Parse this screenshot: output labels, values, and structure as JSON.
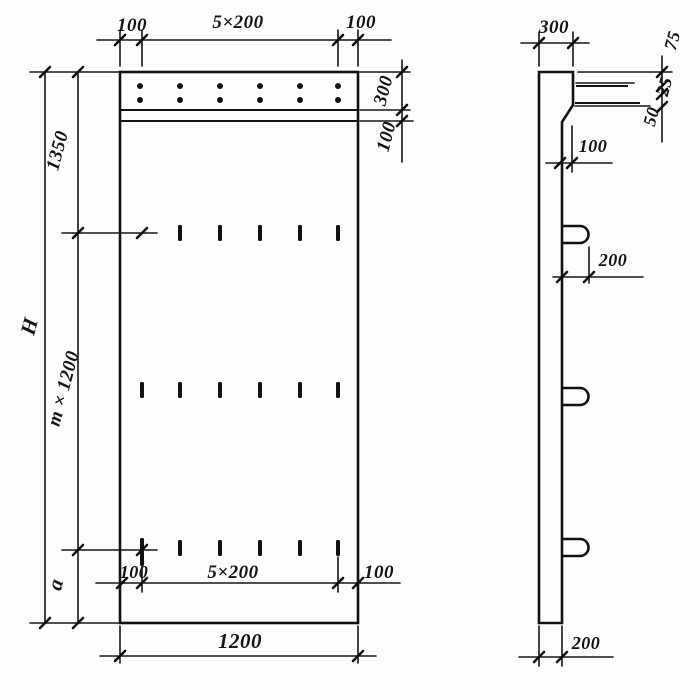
{
  "drawing": {
    "type": "technical-drawing",
    "views": [
      "front elevation of panel",
      "side section of panel"
    ],
    "front_view": {
      "dims_top": {
        "left": "100",
        "center": "5×200",
        "right": "100"
      },
      "dims_right": {
        "band": "300",
        "strip": "100"
      },
      "dims_left": {
        "overall": "H",
        "upper": "1350",
        "middle": "m × 1200",
        "lower": "a"
      },
      "dims_bottom_inner": {
        "left": "100",
        "center": "5×200",
        "right": "100"
      },
      "dims_bottom": {
        "width": "1200"
      },
      "features": {
        "anchor_dot_rows": 2,
        "anchor_dot_columns": 6,
        "slot_rows": 3,
        "slot_columns": 6
      }
    },
    "side_view": {
      "dims": {
        "top_width": "300",
        "chain_1": "75",
        "chain_2": "25",
        "chain_3": "50",
        "ledge_offset": "100",
        "hook_offset": "200",
        "thickness": "200"
      },
      "features": {
        "lifting_hooks": 3
      }
    },
    "ink_color": "#141414",
    "paper_color": "#fdfdfc"
  }
}
